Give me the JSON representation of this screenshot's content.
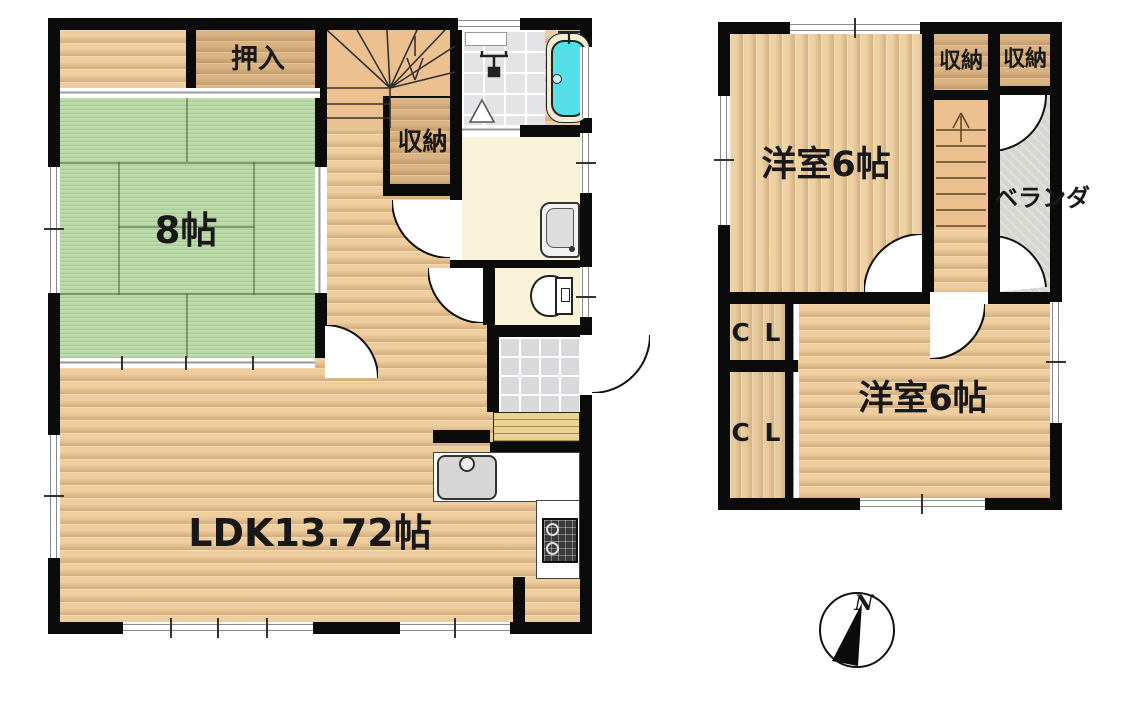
{
  "title": "2-story house floor plan",
  "colors": {
    "wall": "#0b0b0b",
    "wood_floor": "#eecd9e",
    "tatami_green": "#b8d8a5",
    "closet_wood": "#d9b383",
    "stairs": "#ecc18f",
    "sanitary_cream": "#f8f3d9",
    "tile_gray": "#e4e4e6",
    "veranda_gray": "#d7d7d2",
    "bathtub_cyan": "#55dfe8",
    "tub_rim_cream": "#f3edd3",
    "step_wood": "#ead194"
  },
  "floor1": {
    "closet_top": "押入",
    "storage": "収納",
    "tatami_room": "8帖",
    "ldk": "LDK13.72帖"
  },
  "floor2": {
    "room_upper": "洋室6帖",
    "storage_a": "収納",
    "storage_b": "収納",
    "veranda": "ベランダ",
    "closet_a": "C L",
    "closet_b": "C L",
    "room_lower": "洋室6帖"
  },
  "compass": {
    "north_label": "N"
  }
}
